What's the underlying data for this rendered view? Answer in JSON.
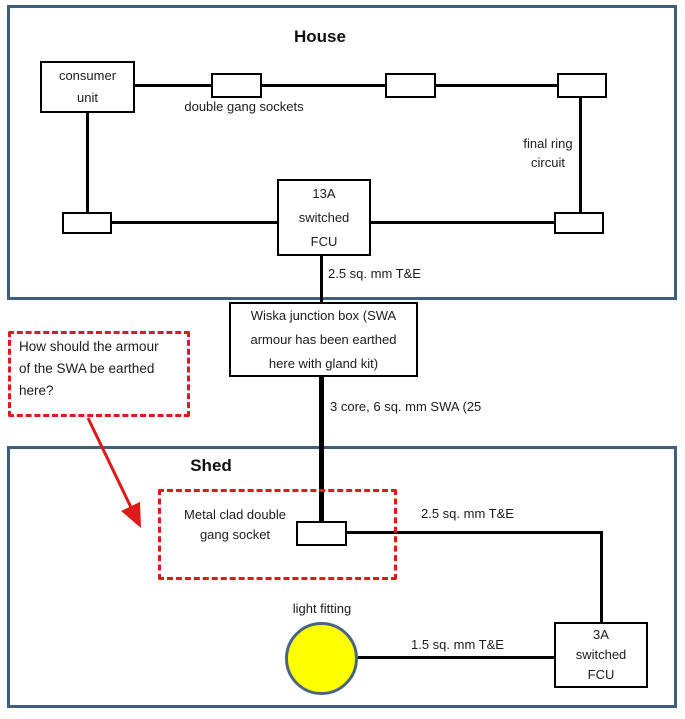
{
  "colors": {
    "frame": "#3f5d7d",
    "wire": "#000000",
    "annotation_red": "#e01919",
    "light_yellow": "#ffff00",
    "light_border": "#4a6583"
  },
  "house": {
    "title": "House",
    "consumer_unit_label": "consumer\nunit",
    "double_gang_sockets_label": "double gang sockets",
    "final_ring_circuit_label": "final ring\ncircuit",
    "fcu_label": "13A\nswitched\nFCU",
    "te_label": "2.5 sq. mm T&E"
  },
  "junction": {
    "wiska_label": "Wiska junction box (SWA\narmour has been earthed\nhere with gland kit)",
    "swa_label": "3 core, 6 sq. mm SWA (25"
  },
  "annotation": {
    "question": "How should the armour\nof the SWA be earthed\nhere?"
  },
  "shed": {
    "title": "Shed",
    "metal_clad_label": "Metal clad double\ngang socket",
    "te_label": "2.5 sq. mm T&E",
    "light_label": "light fitting",
    "light_te_label": "1.5 sq. mm T&E",
    "fcu_label": "3A\nswitched\nFCU"
  }
}
